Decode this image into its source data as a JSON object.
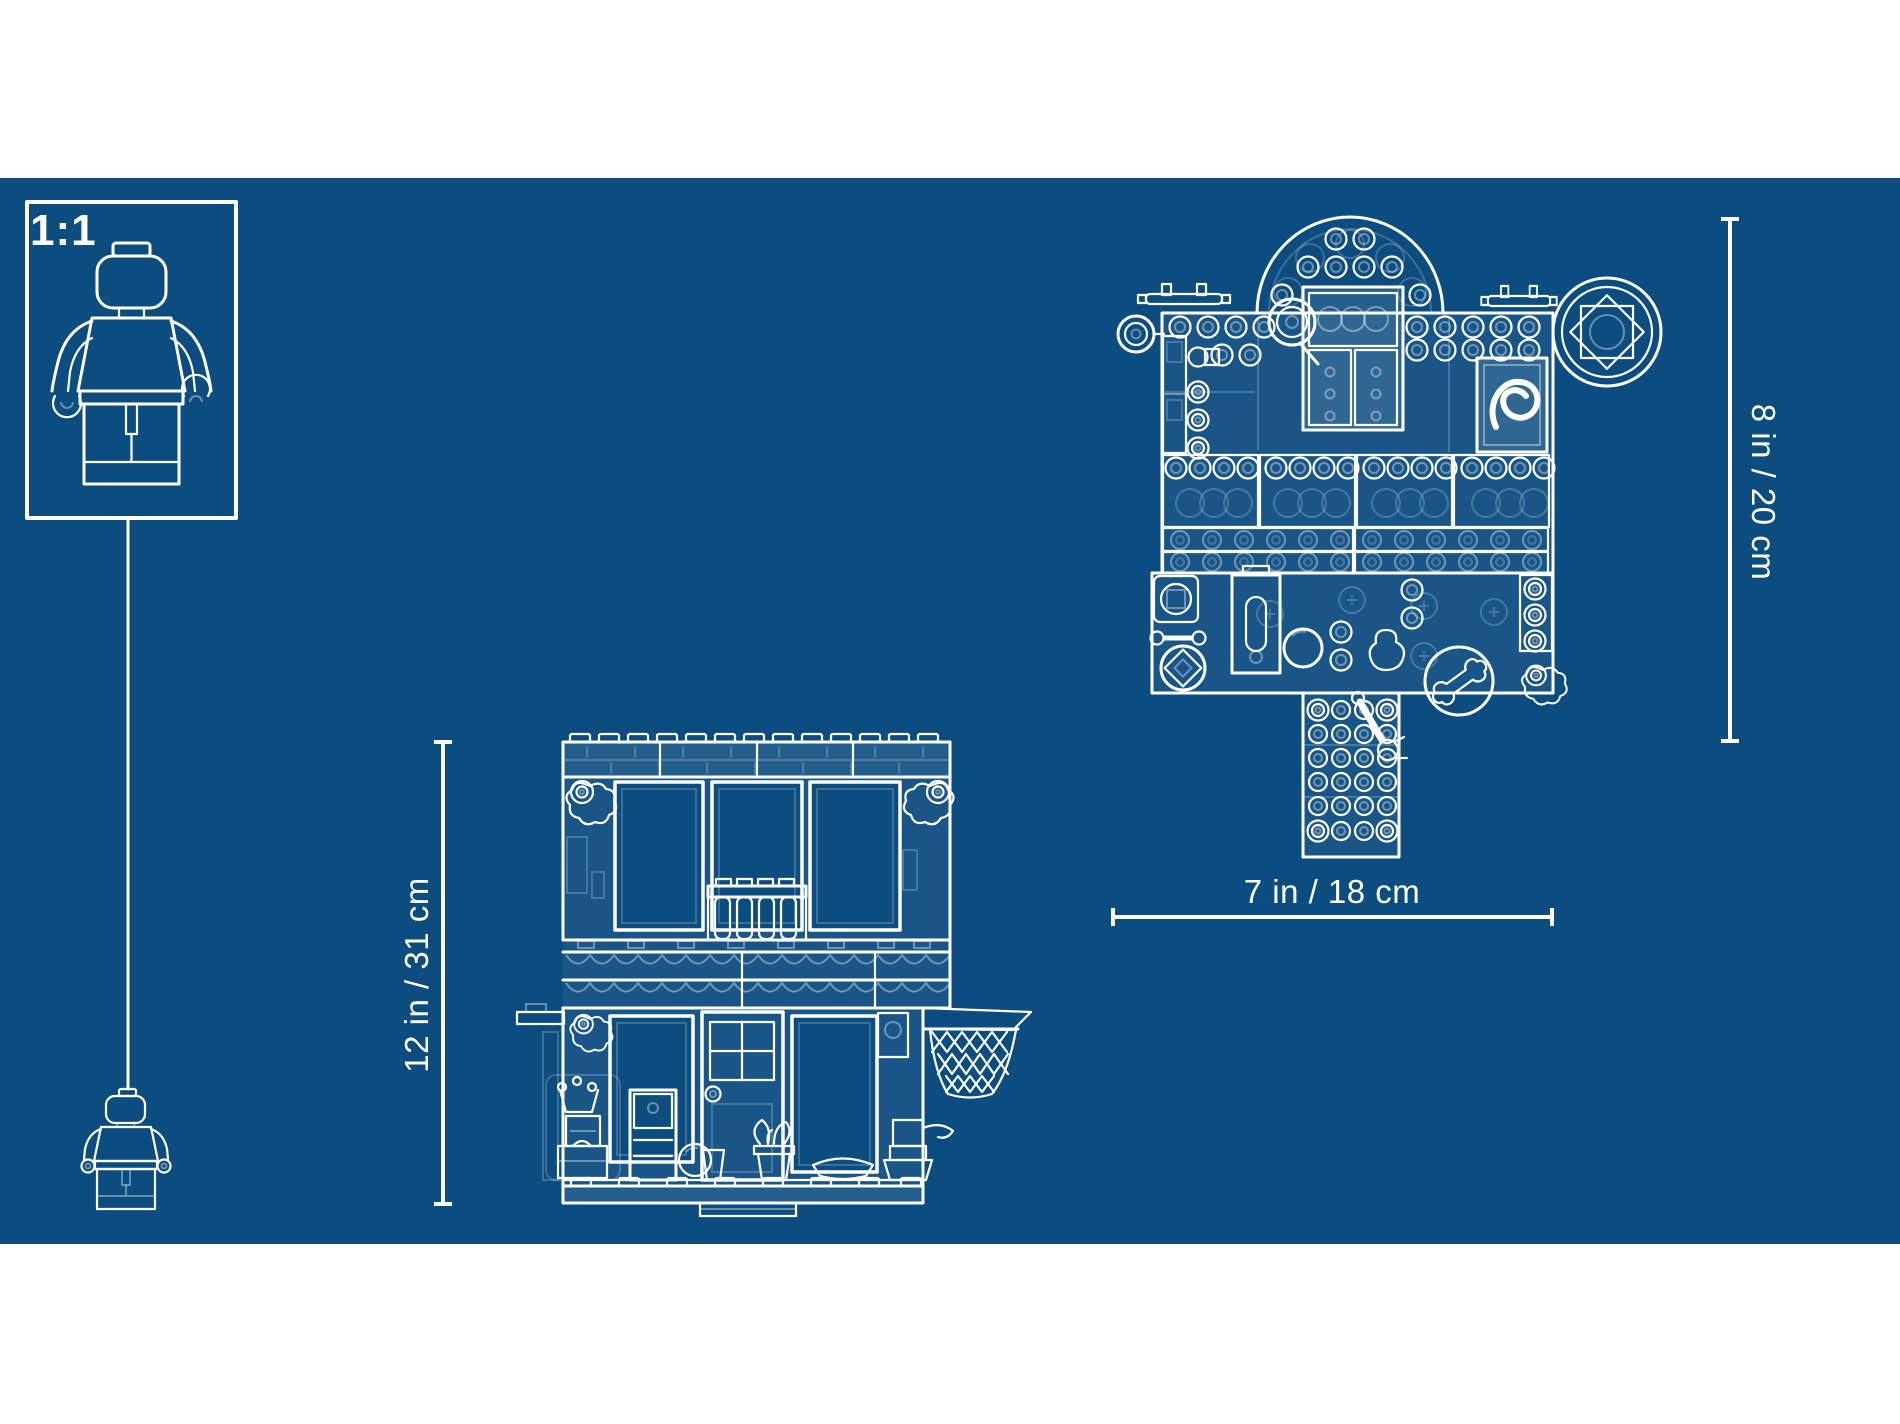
{
  "scale_box": {
    "label": "1:1"
  },
  "dimension_labels": {
    "front_height": "12 in / 31 cm",
    "base_width": "7 in / 18 cm",
    "top_height": "8 in / 20 cm"
  },
  "colors": {
    "blueprint_background": "#0c4c7f",
    "line_art": "#ffffff",
    "page_margin": "#ffffff"
  },
  "artwork": {
    "scale_figure": "minifigure-outline-large",
    "hanging_figure": "minifigure-outline-small",
    "front_view": "house-front-elevation",
    "top_view": "set-top-plan",
    "detail_icons": [
      "basketball-hoop-icon",
      "dome-roof-icon",
      "rosette-dial-icon",
      "bone-tile-icon",
      "wrench-icon",
      "flower-icon",
      "door-icon",
      "balcony-railing-icon",
      "telescope-icon",
      "antenna-icon"
    ]
  }
}
